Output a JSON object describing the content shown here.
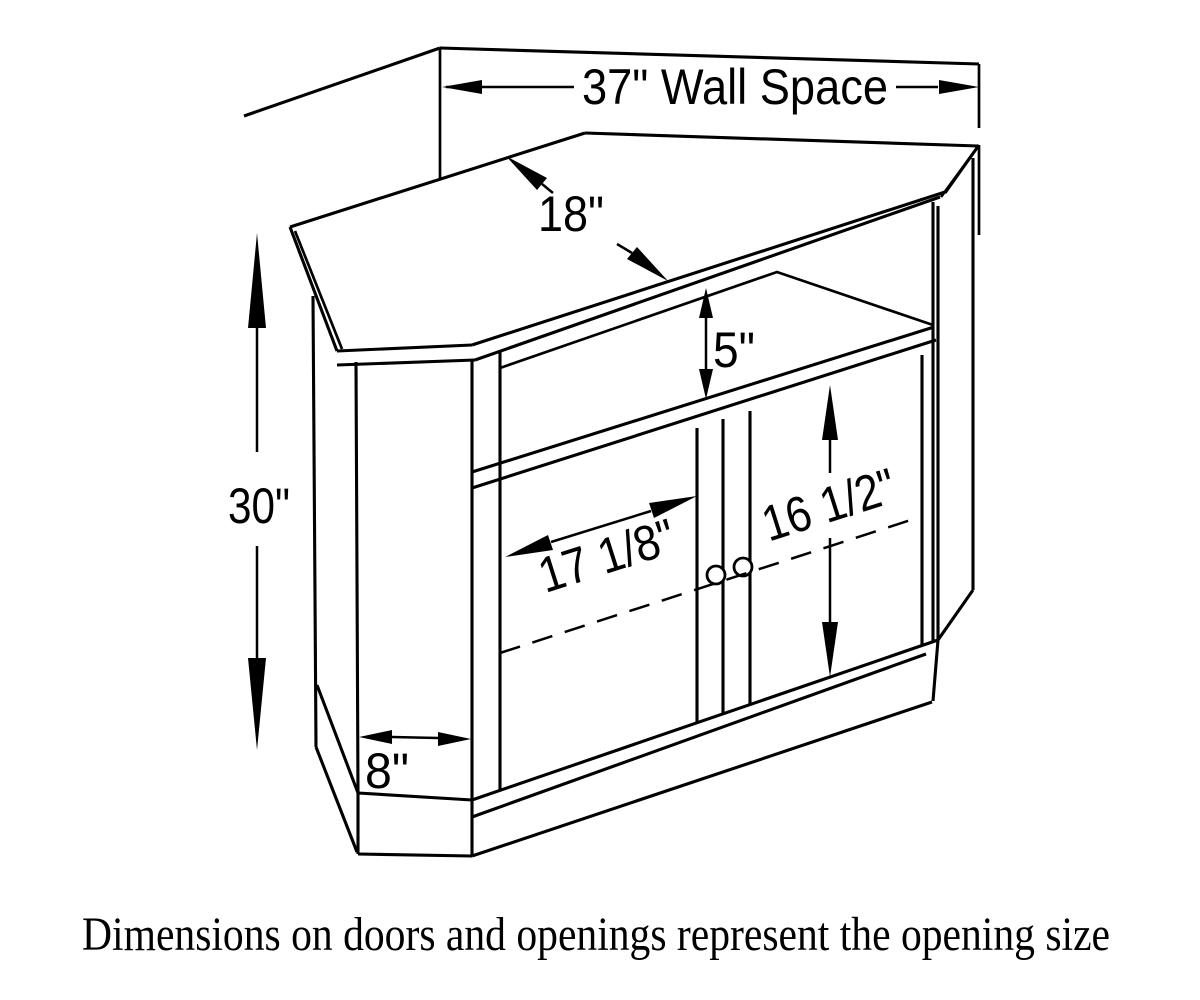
{
  "page": {
    "background": "#ffffff",
    "ink": "#000000"
  },
  "dims": {
    "wall_space": {
      "label": "37\" Wall Space"
    },
    "top_depth": {
      "label": "18\""
    },
    "opening_height": {
      "label": "5\""
    },
    "overall_height": {
      "label": "30\""
    },
    "door_opening_width": {
      "label": "17 1/8\""
    },
    "door_opening_height": {
      "label": "16 1/2\""
    },
    "end_width": {
      "label": "8\""
    }
  },
  "caption": {
    "text": "Dimensions on doors and openings represent the opening size"
  }
}
